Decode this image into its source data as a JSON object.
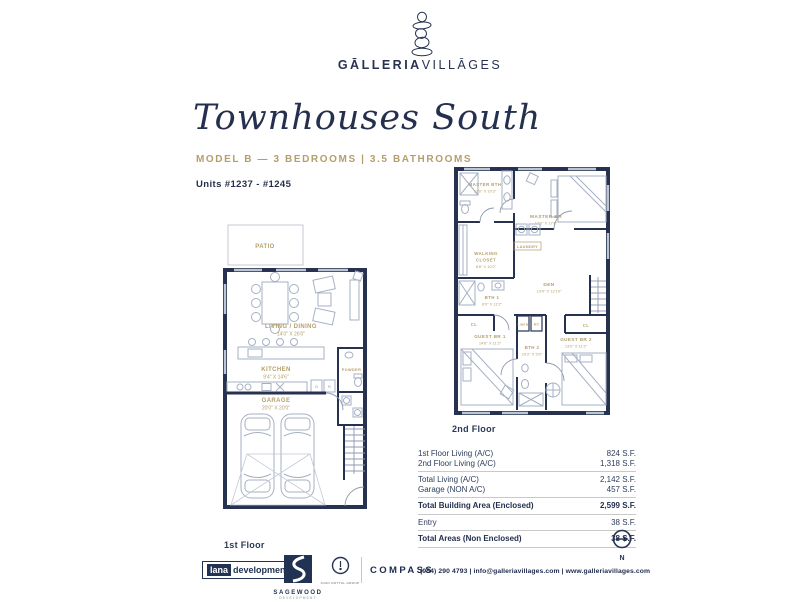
{
  "brand": {
    "name_bold": "GĀLLERIA",
    "name_light": "VILLĀGES"
  },
  "header": {
    "script_title": "Townhouses South",
    "model_line": "MODEL B — 3 BEDROOMS | 3.5 BATHROOMS",
    "units_line": "Units #1237 - #1245"
  },
  "floor1": {
    "caption": "1st Floor",
    "patio": "PATIO",
    "living_name": "LIVING / DINING",
    "living_dims": "14'0\" X 26'0\"",
    "kitchen_name": "KITCHEN",
    "kitchen_dims": "9'4\" X 14'6\"",
    "powder": "POWDER",
    "app1": "G",
    "app2": "R",
    "garage_name": "GARAGE",
    "garage_dims": "20'0\" X 20'0\""
  },
  "floor2": {
    "caption": "2nd Floor",
    "master_bth_name": "MASTER BTH",
    "master_bth_dims": "12'0\" X 10'3\"",
    "master_br_name": "MASTER BR",
    "master_br_dims": "12'0\" X 17'6\"",
    "walking1": "WALKING",
    "walking2": "CLOSET",
    "walking_dims": "8'8\" X 10'2\"",
    "laundry": "LAUNDRY",
    "den_name": "DEN",
    "den_dims": "13'4\" X 12'10\"",
    "bth1_name": "BTH 1",
    "bth1_dims": "6'0\" X 11'2\"",
    "cl_left": "CL",
    "cl_right": "CL",
    "guest1_name": "GUEST BR 1",
    "guest1_dims": "14'6\" X 11'2\"",
    "linen": "LINEN",
    "ac": "AC",
    "bth2_name": "BTH 2",
    "bth2_dims": "10'2\" X 5'0\"",
    "guest2_name": "GUEST BR 2",
    "guest2_dims": "13'0\" X 11'2\""
  },
  "areas": {
    "rows": [
      {
        "label": "1st Floor Living (A/C)",
        "value": "824 S.F."
      },
      {
        "label": "2nd Floor Living (A/C)",
        "value": "1,318 S.F."
      },
      {
        "label": "Total Living (A/C)",
        "value": "2,142 S.F."
      },
      {
        "label": "Garage (NON A/C)",
        "value": "457 S.F."
      },
      {
        "label": "Total Building Area (Enclosed)",
        "value": "2,599 S.F."
      },
      {
        "label": "Entry",
        "value": "38 S.F."
      },
      {
        "label": "Total Areas (Non Enclosed)",
        "value": "38 S.F."
      }
    ]
  },
  "north": {
    "label": "N"
  },
  "footer": {
    "lana_box": "lana",
    "lana_rest": "development",
    "sagewood_name": "SAGEWOOD",
    "sagewood_sub": "DEVELOPMENT",
    "group_logo_text": "JOAN DOTTAL GROUP",
    "compass": "COMPASS",
    "contact": "(954) 290 4793 | info@galleriavillages.com | www.galleriavillages.com"
  },
  "colors": {
    "navy": "#26324f",
    "tan": "#b49e6c",
    "plan_line": "#a6b0c3"
  }
}
